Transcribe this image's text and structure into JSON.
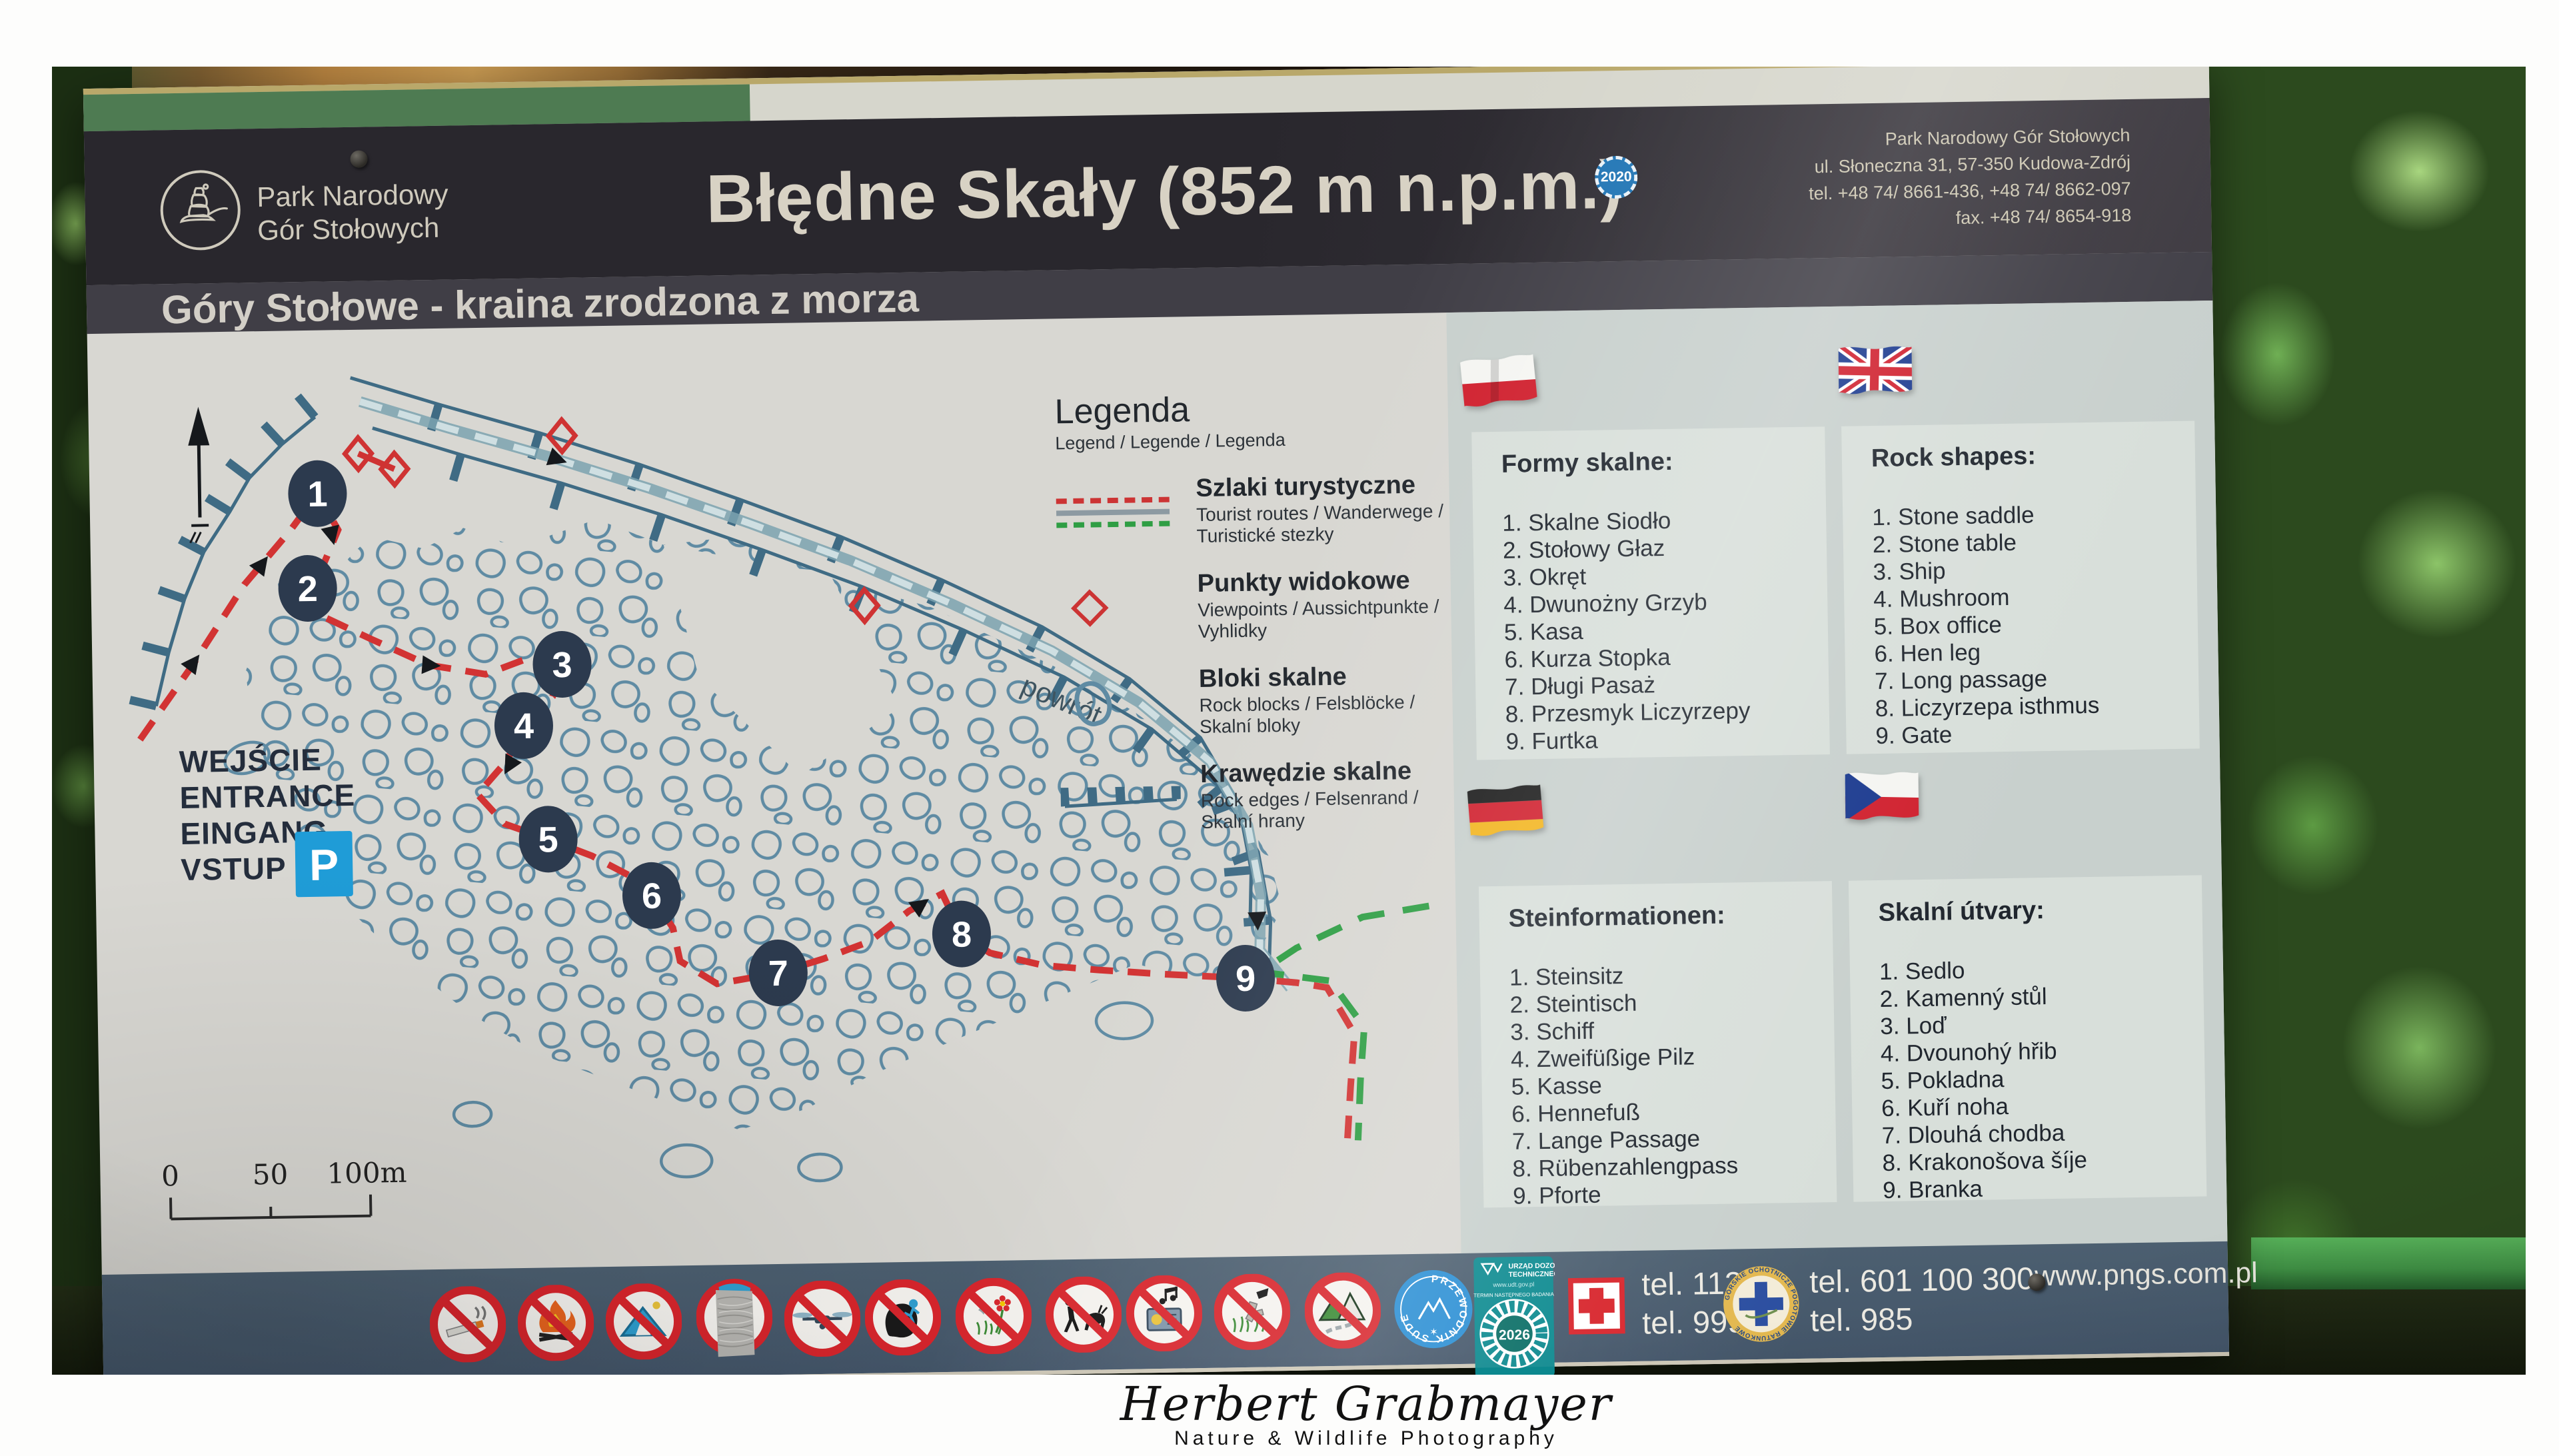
{
  "sign": {
    "header": {
      "org_line1": "Park Narodowy",
      "org_line2": "Gór Stołowych",
      "title": "Błędne Skały (852 m n.p.m.)",
      "badge_year": "2020",
      "address_lines": [
        "Park Narodowy Gór Stołowych",
        "ul. Słoneczna 31, 57-350 Kudowa-Zdrój",
        "tel. +48 74/ 8661-436, +48 74/ 8662-097",
        "fax. +48 74/ 8654-918"
      ]
    },
    "subtitle": "Góry Stołowe - kraina zrodzona z morza",
    "legend": {
      "title": "Legenda",
      "subtitle": "Legend / Legende / Legenda",
      "items": [
        {
          "label": "Szlaki turystyczne",
          "sub": "Tourist routes / Wanderwege / Turistické stezky"
        },
        {
          "label": "Punkty widokowe",
          "sub": "Viewpoints / Aussichtpunkte / Vyhlidky"
        },
        {
          "label": "Bloki skalne",
          "sub": "Rock blocks / Felsblöcke / Skalní bloky"
        },
        {
          "label": "Krawędzie skalne",
          "sub": "Rock edges / Felsenrand / Skalní hrany"
        }
      ]
    },
    "map": {
      "entrance": [
        "WEJŚCIE",
        "ENTRANCE",
        "EINGANG",
        "VSTUP"
      ],
      "parking_label": "P",
      "return_label": "powrót",
      "scale": [
        "0",
        "50",
        "100m"
      ],
      "markers": [
        "1",
        "2",
        "3",
        "4",
        "5",
        "6",
        "7",
        "8",
        "9"
      ]
    },
    "panels": [
      {
        "lang": "pl",
        "heading": "Formy skalne:",
        "items": [
          "Skalne Siodło",
          "Stołowy Głaz",
          "Okręt",
          "Dwunożny Grzyb",
          "Kasa",
          "Kurza Stopka",
          "Długi Pasaż",
          "Przesmyk Liczyrzepy",
          "Furtka"
        ]
      },
      {
        "lang": "en",
        "heading": "Rock shapes:",
        "items": [
          "Stone saddle",
          "Stone table",
          "Ship",
          "Mushroom",
          "Box office",
          "Hen leg",
          "Long passage",
          "Liczyrzepa isthmus",
          "Gate"
        ]
      },
      {
        "lang": "de",
        "heading": "Steinformationen:",
        "items": [
          "Steinsitz",
          "Steintisch",
          "Schiff",
          "Zweifüßige Pilz",
          "Kasse",
          "Hennefuß",
          "Lange Passage",
          "Rübenzahlengpass",
          "Pforte"
        ]
      },
      {
        "lang": "cz",
        "heading": "Skalní útvary:",
        "items": [
          "Sedlo",
          "Kamenný stůl",
          "Loď",
          "Dvounohý hřib",
          "Pokladna",
          "Kuří noha",
          "Dlouhá chodba",
          "Krakonošova šíje",
          "Branka"
        ]
      }
    ],
    "footer": {
      "pictograms": [
        "no-smoking",
        "no-campfires",
        "no-camping",
        "taped-over-sign",
        "no-drones",
        "no-climbing",
        "no-flower-picking",
        "no-wildlife-disturbing",
        "no-loud-music",
        "no-littering",
        "no-off-trail"
      ],
      "guide_sticker": "PRZEWODNIK SUDECKI",
      "udt": {
        "org_line1": "URZĄD DOZORU",
        "org_line2": "TECHNICZNEGO",
        "url": "www.udt.gov.pl",
        "label": "TERMIN NASTĘPNEGO BADANIA",
        "year": "2026"
      },
      "emergency": {
        "medical": [
          "tel. 112",
          "tel. 999"
        ],
        "mountain_rescue": [
          "tel. 601 100 300",
          "tel. 985"
        ]
      },
      "gopr_ring": "GÓRSKIE OCHOTNICZE POGOTOWIE RATUNKOWE",
      "website": "www.pngs.com.pl"
    }
  },
  "credit": {
    "name": "Herbert Grabmayer",
    "tagline": "Nature & Wildlife Photography"
  },
  "colors": {
    "header_bg": "#29272d",
    "subband_bg": "#403e46",
    "body_bg": "#d8d7d2",
    "panel_bg": "#c8d0cd",
    "card_bg": "#d8dfda",
    "footer_bg": "#46586a",
    "trail_red": "#d23333",
    "trail_green": "#2e9e44",
    "rock_blue": "#5f8ba3",
    "parking_blue": "#1f9cd7",
    "prohibition_red": "#d8252c"
  }
}
